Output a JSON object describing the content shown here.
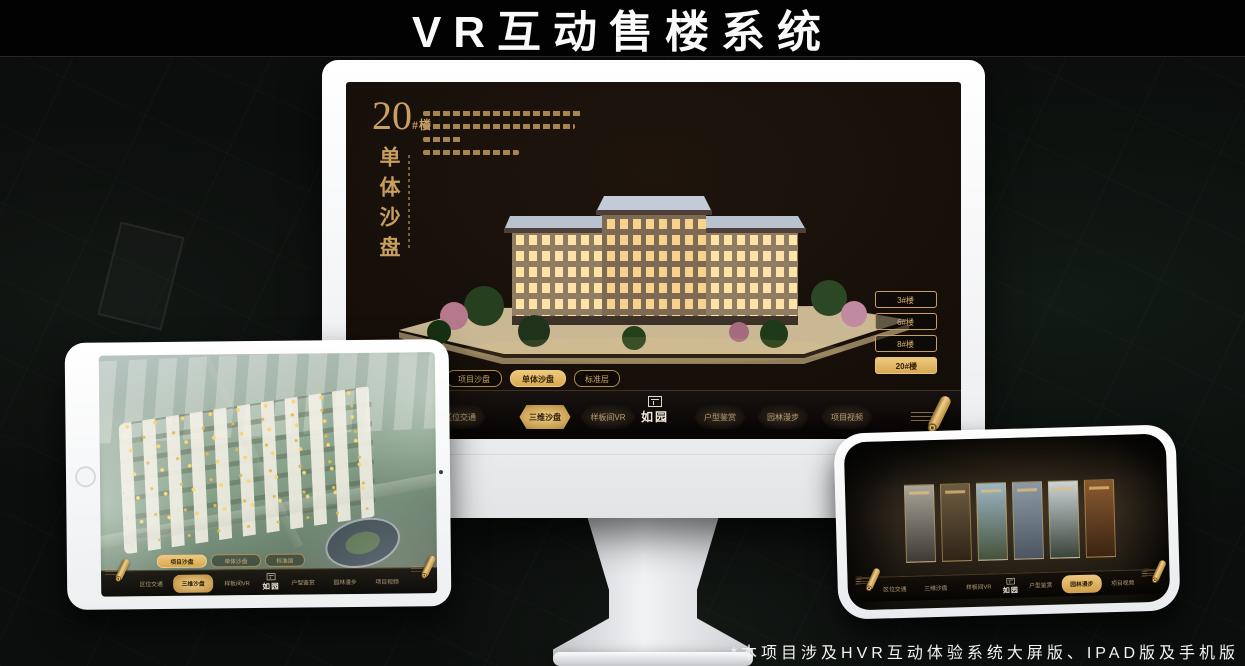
{
  "page": {
    "title": "VR互动售楼系统",
    "footnote": "*本项目涉及HVR互动体验系统大屏版、IPAD版及手机版"
  },
  "colors": {
    "gold": "#c9a063",
    "gold_bright": "#eac87e",
    "page_bg": "#0b0e0c"
  },
  "desktop": {
    "building_no": "20",
    "building_unit": "#楼",
    "section_title": "单体沙盘",
    "floor_buttons": {
      "items": [
        {
          "label": "3#楼"
        },
        {
          "label": "6#楼"
        },
        {
          "label": "8#楼"
        },
        {
          "label": "20#楼",
          "active": true
        }
      ]
    },
    "sub_tabs": {
      "items": [
        {
          "label": "项目沙盘"
        },
        {
          "label": "单体沙盘",
          "active": true
        },
        {
          "label": "标准层"
        }
      ]
    },
    "nav": {
      "logo": "如园",
      "items": [
        {
          "label": "区位交通"
        },
        {
          "label": "三维沙盘",
          "active": true
        },
        {
          "label": "样板间VR"
        },
        {
          "label": "户型鉴赏"
        },
        {
          "label": "园林漫步"
        },
        {
          "label": "项目视频"
        }
      ]
    }
  },
  "tablet": {
    "sub_tabs": {
      "items": [
        {
          "label": "项目沙盘",
          "active": true
        },
        {
          "label": "单体沙盘"
        },
        {
          "label": "标准层"
        }
      ]
    },
    "nav": {
      "logo": "如园",
      "items": [
        {
          "label": "区位交通"
        },
        {
          "label": "三维沙盘",
          "active": true
        },
        {
          "label": "样板间VR"
        },
        {
          "label": "户型鉴赏"
        },
        {
          "label": "园林漫步"
        },
        {
          "label": "项目视频"
        }
      ]
    }
  },
  "phone": {
    "nav": {
      "logo": "如园",
      "items": [
        {
          "label": "区位交通"
        },
        {
          "label": "三维沙盘"
        },
        {
          "label": "样板间VR"
        },
        {
          "label": "户型鉴赏"
        },
        {
          "label": "园林漫步",
          "active": true
        },
        {
          "label": "项目视频"
        }
      ]
    },
    "gallery": {
      "panels": [
        {
          "top": "#a8a49a",
          "bottom": "#3c3a33"
        },
        {
          "top": "#6e5c42",
          "bottom": "#2e2416"
        },
        {
          "top": "#9db6c4",
          "bottom": "#45523a"
        },
        {
          "top": "#8d9aa6",
          "bottom": "#4a5560"
        },
        {
          "top": "#ccd4d6",
          "bottom": "#39443a"
        },
        {
          "top": "#8a5a30",
          "bottom": "#3a2412"
        }
      ]
    }
  }
}
